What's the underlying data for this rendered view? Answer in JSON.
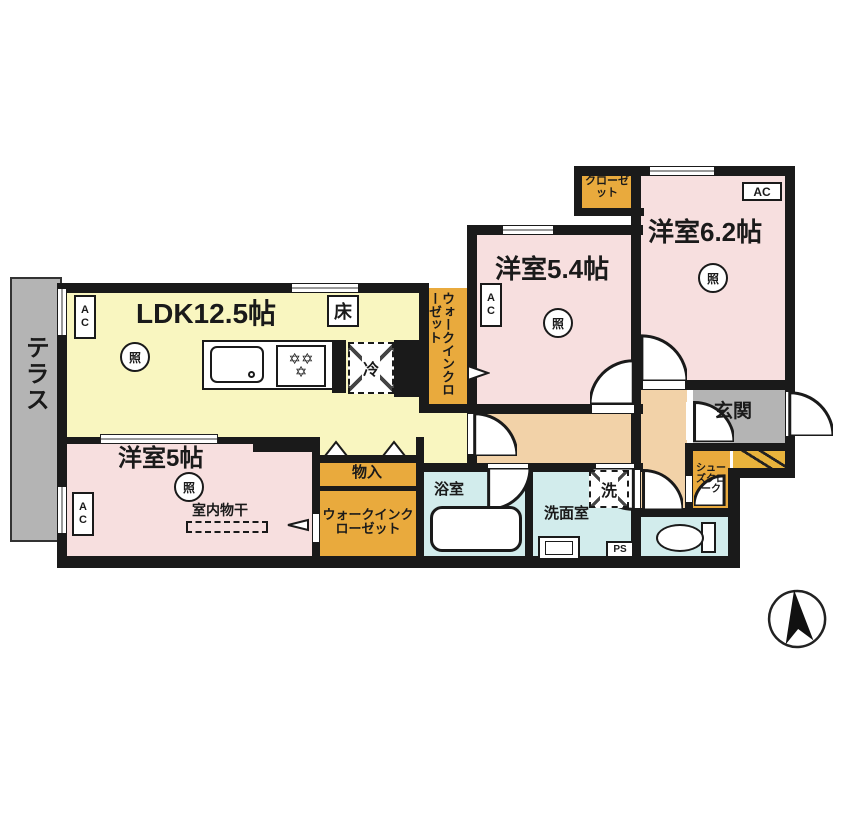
{
  "plan": {
    "terrace": "テラス",
    "ldk": "LDK12.5帖",
    "bedroom5": "洋室5帖",
    "bedroom5_note": "室内物干",
    "bedroom54": "洋室5.4帖",
    "bedroom62": "洋室6.2帖",
    "closet": "クローゼット",
    "walkin_closet_side": "ウォークインクローゼット",
    "walkin_closet_bottom": "ウォークインクローゼット",
    "storage": "物入",
    "bath": "浴室",
    "washroom": "洗面室",
    "entrance": "玄関",
    "shoes_closet": "シューズクローク"
  },
  "symbols": {
    "light": "照",
    "ac": "AC",
    "floor_heating": "床",
    "fridge": "冷",
    "washer": "洗",
    "pipe_space": "PS",
    "burner": "✡"
  },
  "colors": {
    "wall": "#1a1a1a",
    "ldk_fill": "#f9f6c0",
    "bedroom_fill": "#f7dfdf",
    "closet_fill": "#e9aa3d",
    "wet_area_fill": "#d2ecec",
    "hallway_fill": "#f2d2a8",
    "terrace_fill": "#b4b4b4",
    "entrance_fill": "#b4b4b4",
    "entrance_step_fill": "#e8b33c"
  }
}
